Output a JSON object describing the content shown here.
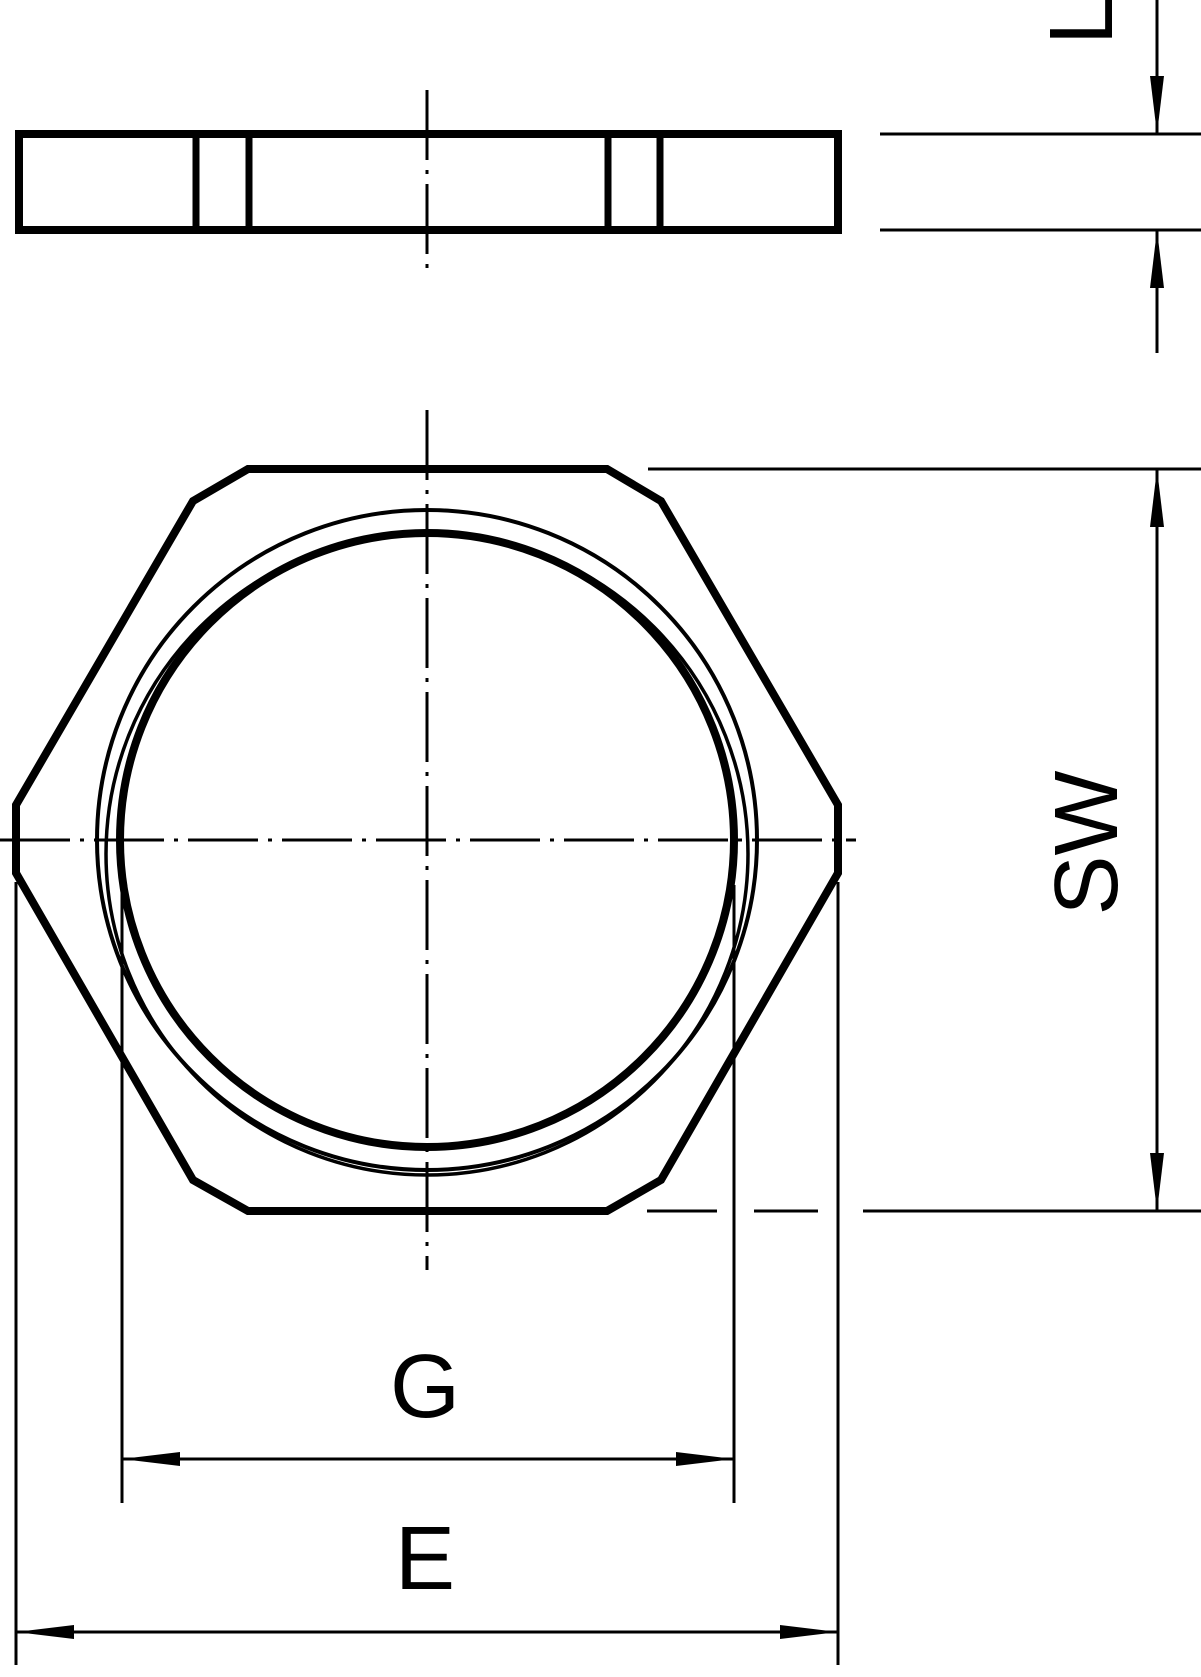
{
  "drawing": {
    "background_color": "#ffffff",
    "line_color": "#000000",
    "dimension_labels": {
      "thickness": "L",
      "across_flats": "SW",
      "thread": "G",
      "across_corners": "E"
    }
  }
}
